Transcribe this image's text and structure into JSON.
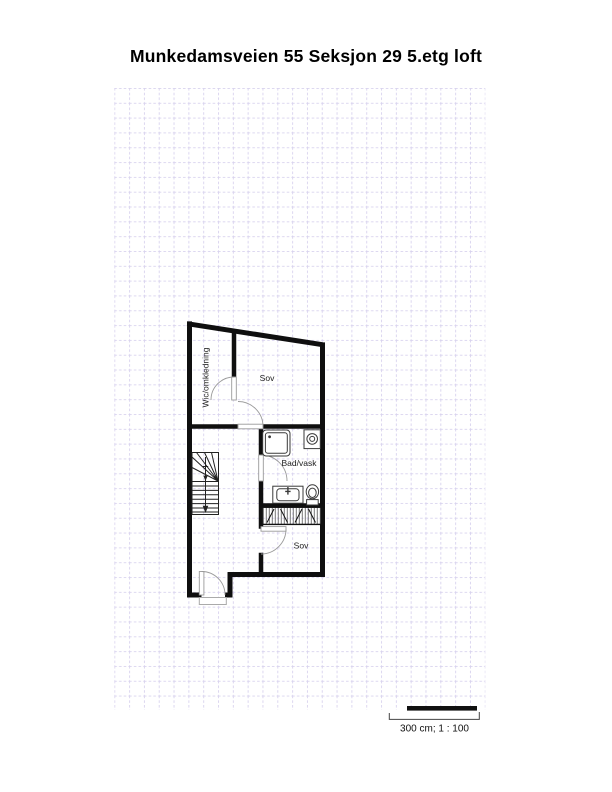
{
  "title": "Munkedamsveien 55 Seksjon 29 5.etg loft",
  "plan": {
    "rooms": [
      {
        "id": "wic",
        "label": "Wic/omkledning"
      },
      {
        "id": "sov-upper",
        "label": "Sov"
      },
      {
        "id": "bad-vask",
        "label": "Bad/vask"
      },
      {
        "id": "sov-lower",
        "label": "Sov"
      }
    ],
    "symbols": [
      "staircase",
      "shower",
      "washing-machine",
      "sink",
      "toilet",
      "wardrobe",
      "entrance-door"
    ]
  },
  "scale_bar": {
    "label": "300 cm; 1 : 100",
    "length_cm": "300",
    "ratio": "1 : 100"
  },
  "colors": {
    "wall": "#0f0f0f",
    "grid_line": "#d8d2ee",
    "door": "#9a9a9a",
    "fixture": "#3a3a3a",
    "stair": "#222222",
    "label_text": "#1c1c1c",
    "background": "#ffffff"
  }
}
